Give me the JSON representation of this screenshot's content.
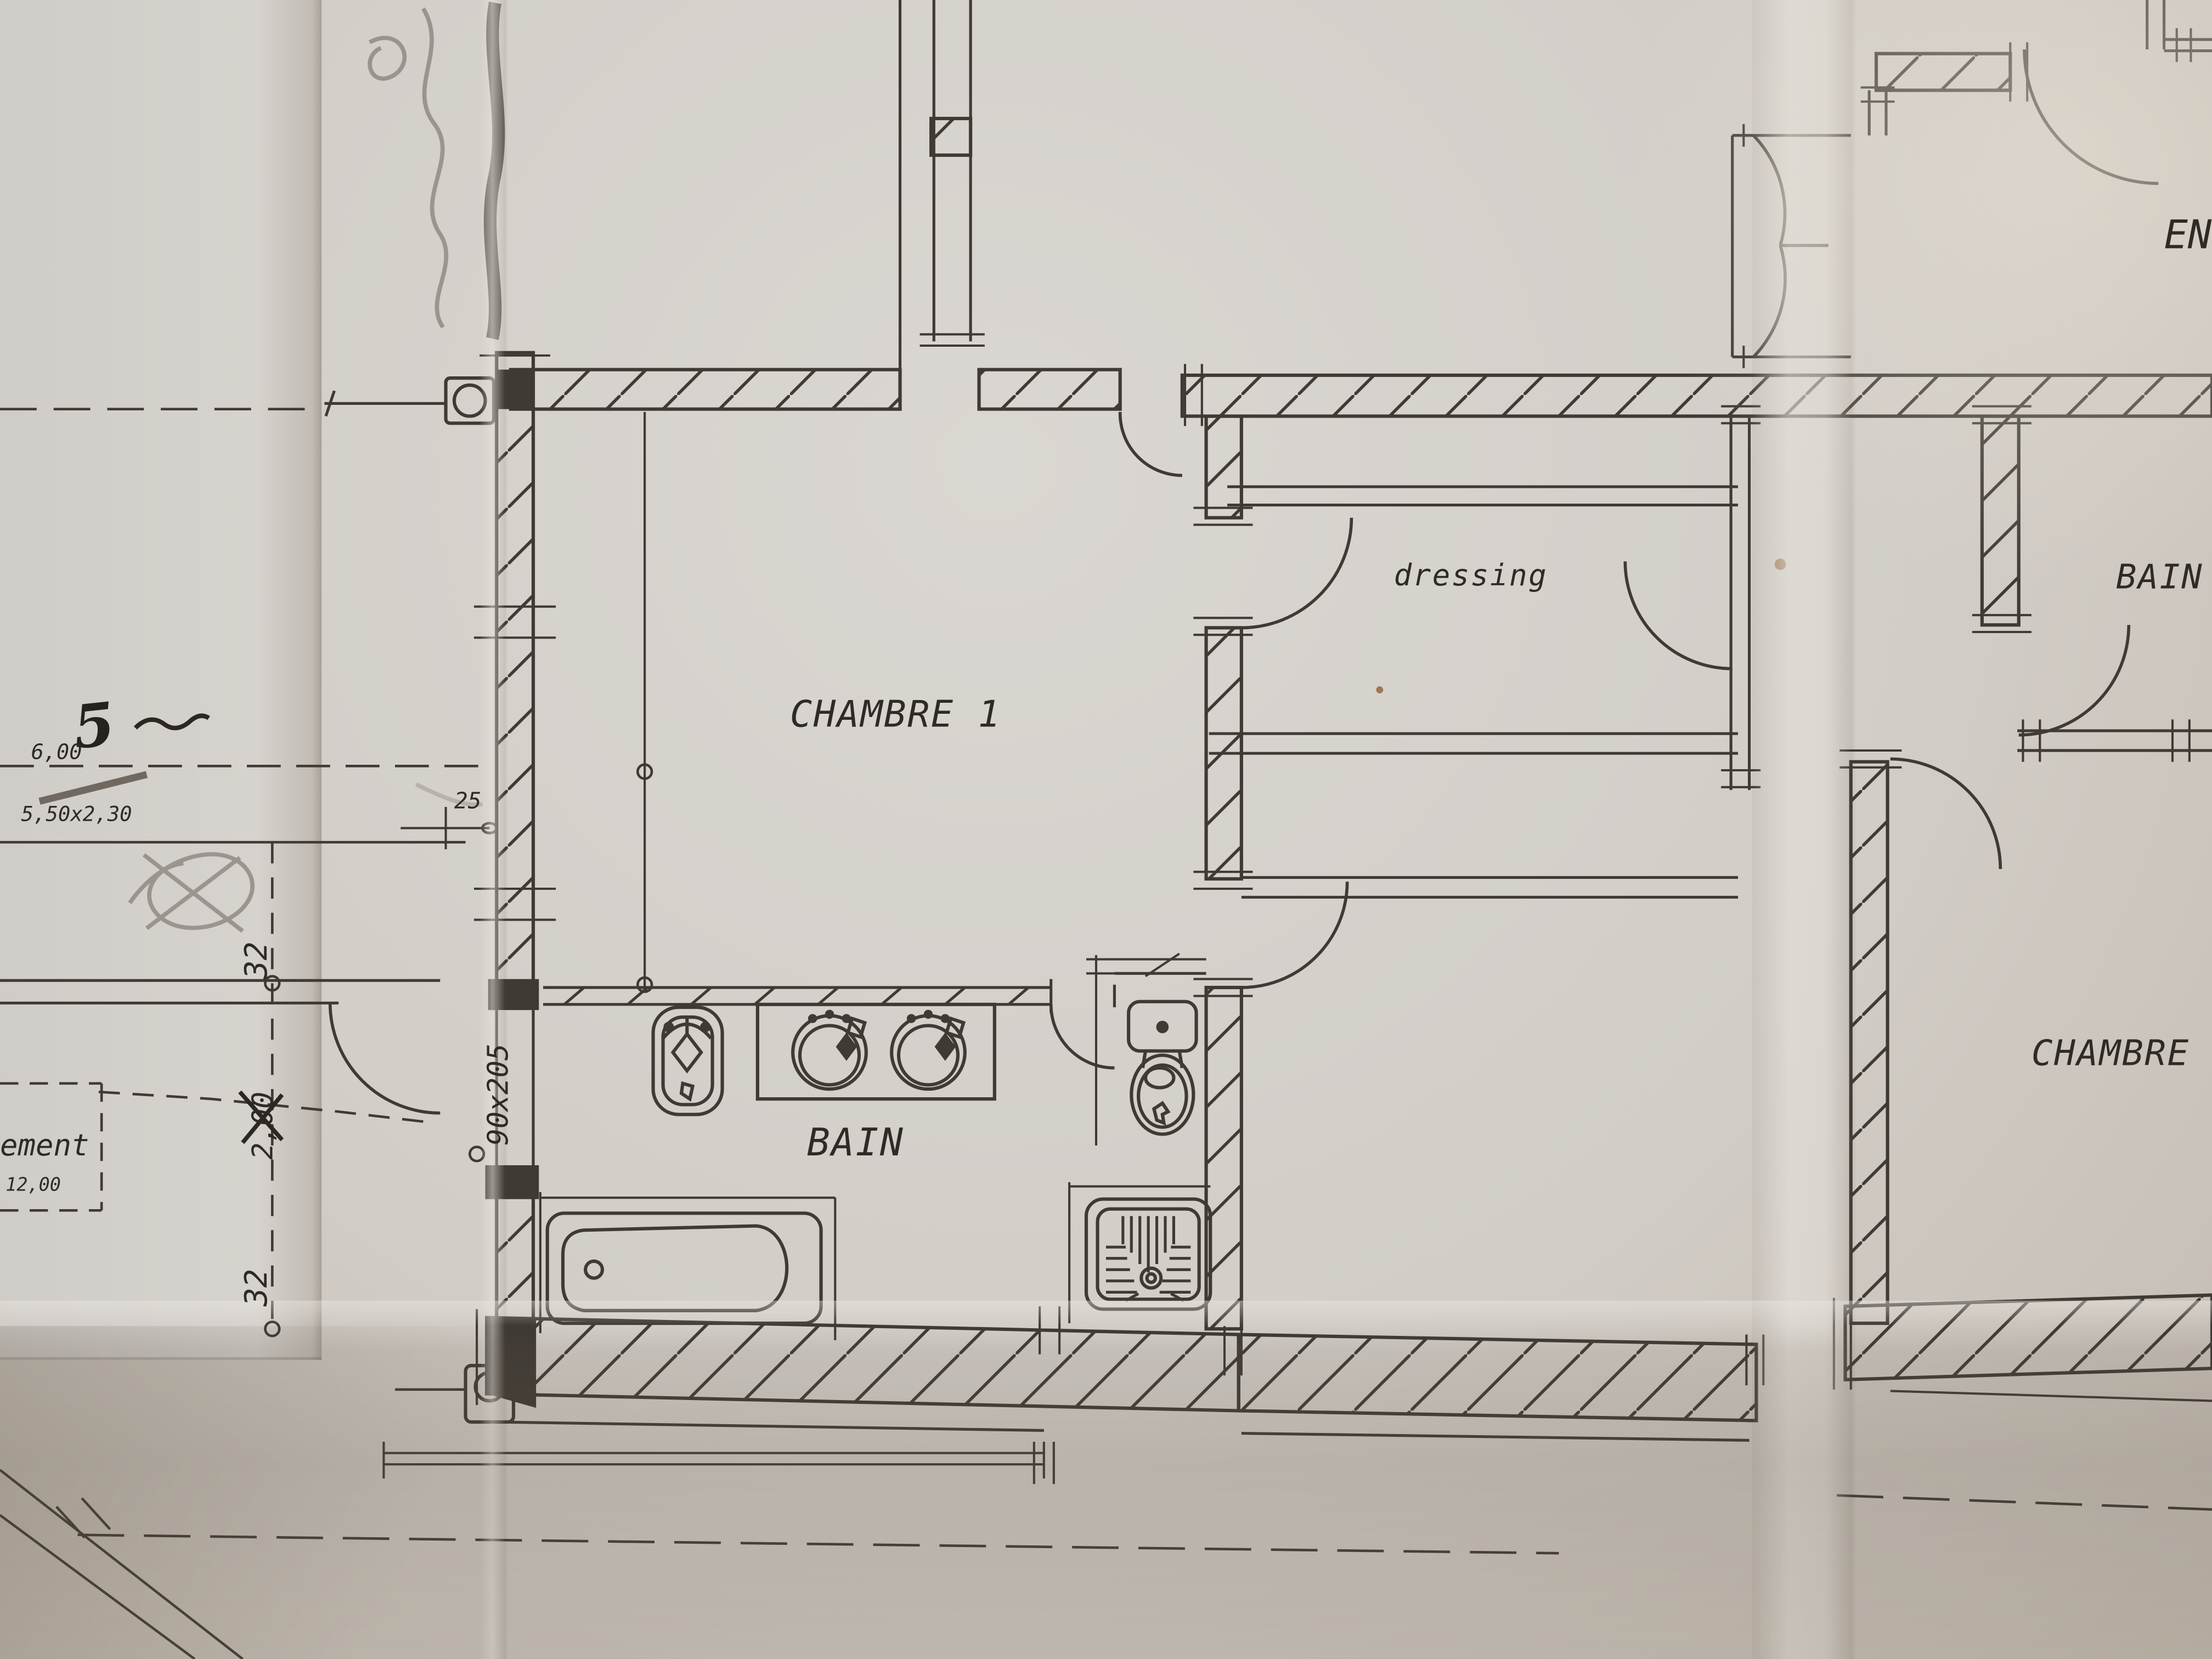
{
  "document": {
    "kind": "architectural floor plan photograph",
    "paper_color": "#d3cfca",
    "ink_color": "#3f3a34"
  },
  "rooms": {
    "chambre1": "CHAMBRE 1",
    "dressing": "dressing",
    "bain_main": "BAIN",
    "bain_right": "BAIN",
    "chambre2": "CHAMBRE 2",
    "entree_partial": "EN"
  },
  "dimensions": {
    "handwritten_five": "5",
    "six_meters": "6,00",
    "window_size": "5,50x2,30",
    "offset_25": "25",
    "thirty_two_upper": "32",
    "two_meters": "2,00",
    "thirty_two_lower": "32",
    "door_size": "90x205",
    "label_fragment": "ement",
    "twelve_meters": "12,00"
  }
}
